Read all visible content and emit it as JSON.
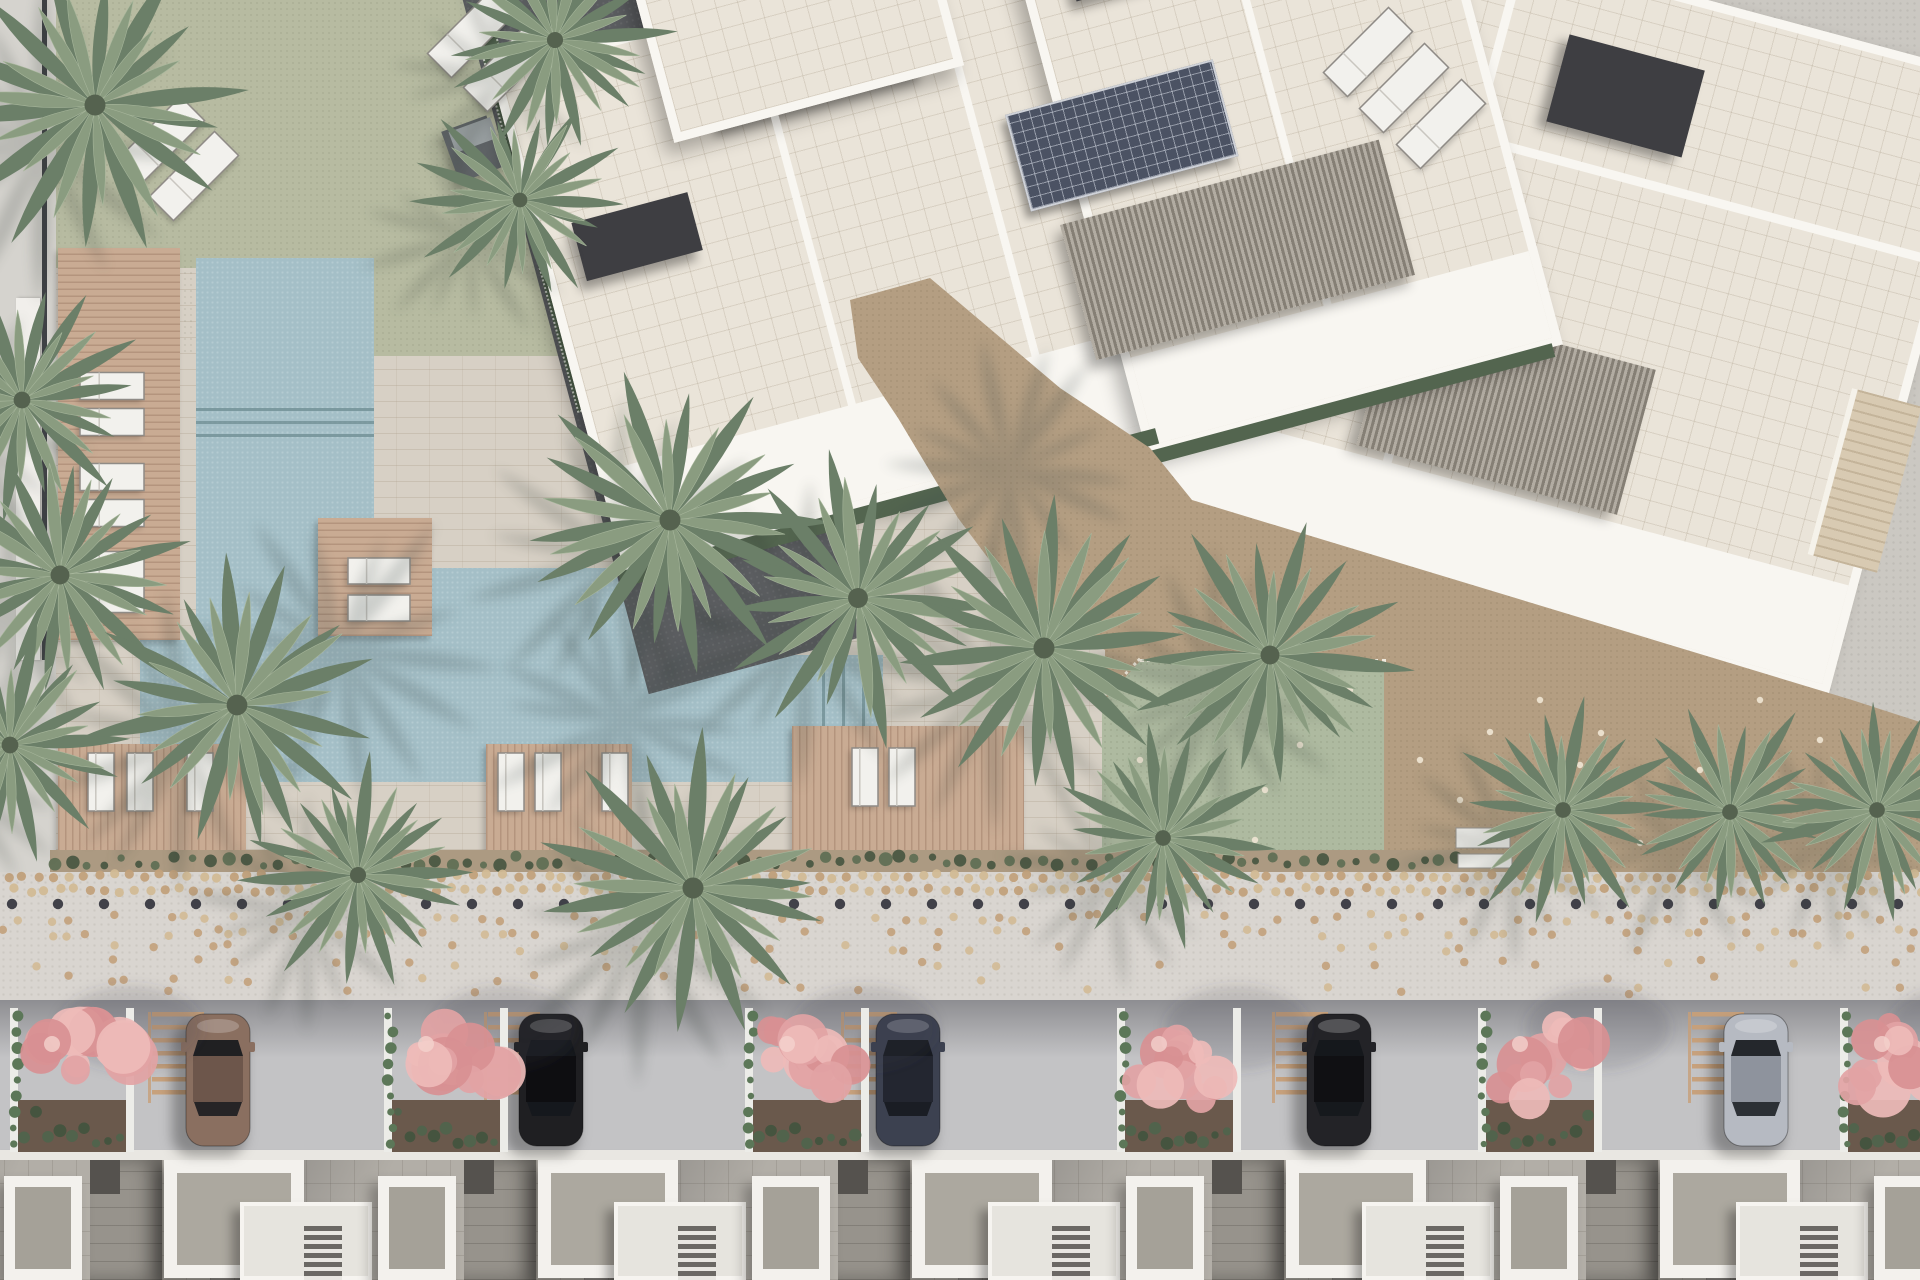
{
  "scene_title": "Residential complex site plan – top view render",
  "palette": {
    "pave1": "#d7d0c5",
    "pave2": "#cbc8c2",
    "side": "#d5d3ce",
    "lawn": "#b7bba1",
    "pool": "#a4bfc7",
    "deck": "#c9ab93",
    "path": "#5b5d60",
    "roof": "#eae4d9",
    "parapet": "#f8f6f1",
    "solar": "#4b5263",
    "tan": "#b49e82",
    "patch": "#aebaa0",
    "soil": "#ac9a82",
    "prom": "#d9d5d0",
    "street": "#c3c3c5",
    "housebase": "#b2aea7",
    "hedge": "#53654f",
    "palm_dark": "#6b7f68",
    "palm_light": "#8a9c80",
    "palm_shadow": "#2e3830",
    "dot_tan": "#c2a17b",
    "dot_tan2": "#d2ba95",
    "dot_dark": "#414149",
    "stripe": "#c79f78",
    "tuft1": "#45543f",
    "tuft2": "#5c6d52",
    "pink1": "#e2a3a4",
    "pink2": "#eebbb8",
    "pink3": "#d89092"
  },
  "building": {
    "left_wing_angle_deg": -15,
    "right_wing_angle_deg": 15,
    "solar_arrays": 2,
    "pergolas": 2
  },
  "palms": [
    {
      "x": 95,
      "y": 105,
      "r": 150
    },
    {
      "x": 555,
      "y": 40,
      "r": 115
    },
    {
      "x": 520,
      "y": 200,
      "r": 105
    },
    {
      "x": 22,
      "y": 400,
      "r": 120
    },
    {
      "x": 60,
      "y": 575,
      "r": 135
    },
    {
      "x": 10,
      "y": 745,
      "r": 120
    },
    {
      "x": 237,
      "y": 705,
      "r": 148
    },
    {
      "x": 358,
      "y": 875,
      "r": 115
    },
    {
      "x": 693,
      "y": 888,
      "r": 150
    },
    {
      "x": 670,
      "y": 520,
      "r": 150
    },
    {
      "x": 858,
      "y": 598,
      "r": 142
    },
    {
      "x": 1044,
      "y": 648,
      "r": 150
    },
    {
      "x": 1163,
      "y": 838,
      "r": 112
    },
    {
      "x": 1270,
      "y": 655,
      "r": 135
    },
    {
      "x": 1563,
      "y": 810,
      "r": 112
    },
    {
      "x": 1730,
      "y": 812,
      "r": 112
    },
    {
      "x": 1877,
      "y": 810,
      "r": 112
    }
  ],
  "pool_shadow_palms": [
    {
      "x": 340,
      "y": 650,
      "r": 150
    },
    {
      "x": 620,
      "y": 720,
      "r": 140
    },
    {
      "x": 1010,
      "y": 470,
      "r": 130
    }
  ],
  "loungers": {
    "lawn_diagonal": [
      {
        "x": 160,
        "y": 141
      },
      {
        "x": 194,
        "y": 176
      },
      {
        "x": 472,
        "y": 33
      },
      {
        "x": 508,
        "y": 67
      },
      {
        "x": 1368,
        "y": 52
      },
      {
        "x": 1404,
        "y": 88
      },
      {
        "x": 1441,
        "y": 124
      }
    ],
    "deck_left_x": 80,
    "deck_left_y": [
      373,
      409,
      464,
      500,
      552,
      586
    ],
    "island_x": 348,
    "island_y": [
      558,
      595
    ],
    "bottom_vertical": [
      {
        "x": 88,
        "y": 753
      },
      {
        "x": 127,
        "y": 753
      },
      {
        "x": 187,
        "y": 753
      },
      {
        "x": 498,
        "y": 753
      },
      {
        "x": 535,
        "y": 753
      },
      {
        "x": 602,
        "y": 753
      },
      {
        "x": 852,
        "y": 748
      },
      {
        "x": 889,
        "y": 748
      }
    ]
  },
  "benches": [
    {
      "x": 1456,
      "y": 828,
      "w": 54,
      "h": 20
    },
    {
      "x": 1458,
      "y": 854,
      "w": 54,
      "h": 14
    }
  ],
  "cars": [
    {
      "name": "bronze-car",
      "x": 218,
      "body": "#8a6f60",
      "roof": "#6d564b"
    },
    {
      "name": "black-car-1",
      "x": 551,
      "body": "#1f1f22",
      "roof": "#0e0e11"
    },
    {
      "name": "navy-car",
      "x": 908,
      "body": "#3c4150",
      "roof": "#232630"
    },
    {
      "name": "black-car-2",
      "x": 1339,
      "body": "#232327",
      "roof": "#101013"
    },
    {
      "name": "silver-car",
      "x": 1756,
      "body": "#b6bac2",
      "roof": "#8e939d"
    }
  ],
  "car_geometry": {
    "top_y": 1014,
    "length": 132,
    "width": 64
  },
  "pink_trees": {
    "planter_x": [
      72,
      446,
      807,
      1179,
      1540,
      1902
    ],
    "canopy_y": 1062,
    "planter_top": 1008,
    "planter_h": 144
  },
  "parking_stripes": {
    "x": [
      152,
      488,
      845,
      1276,
      1692
    ],
    "y": 1012,
    "rungs": 7,
    "step": 13,
    "w": 52,
    "h": 4.5
  },
  "promenade_dots": {
    "dense_rows_y": [
      876,
      890
    ],
    "dense_step": 15,
    "dense_r": 4.6,
    "dark_row": {
      "y": 904,
      "step": 46,
      "r": 5.2,
      "x0": 12
    },
    "scatter_rows_y": [
      918,
      933,
      948,
      963,
      978,
      991
    ],
    "scatter_probs": [
      0.5,
      0.38,
      0.28,
      0.2,
      0.14,
      0.09
    ],
    "scatter_step": 15
  },
  "hedge_tufts": {
    "x0": 55,
    "x1": 1465,
    "step": 13,
    "y": 861
  },
  "tan_speckles": [
    [
      1140,
      760
    ],
    [
      1215,
      700
    ],
    [
      1300,
      745
    ],
    [
      1170,
      820
    ],
    [
      1420,
      760
    ],
    [
      1490,
      732
    ],
    [
      1601,
      733
    ],
    [
      1640,
      843
    ],
    [
      1700,
      770
    ],
    [
      1540,
      700
    ],
    [
      1820,
      740
    ],
    [
      1760,
      700
    ],
    [
      1265,
      790
    ],
    [
      1350,
      690
    ],
    [
      1460,
      800
    ],
    [
      1580,
      765
    ],
    [
      1130,
      690
    ],
    [
      1255,
      840
    ]
  ],
  "houses": {
    "start_x": -284,
    "unit_w": 374,
    "count": 7
  }
}
